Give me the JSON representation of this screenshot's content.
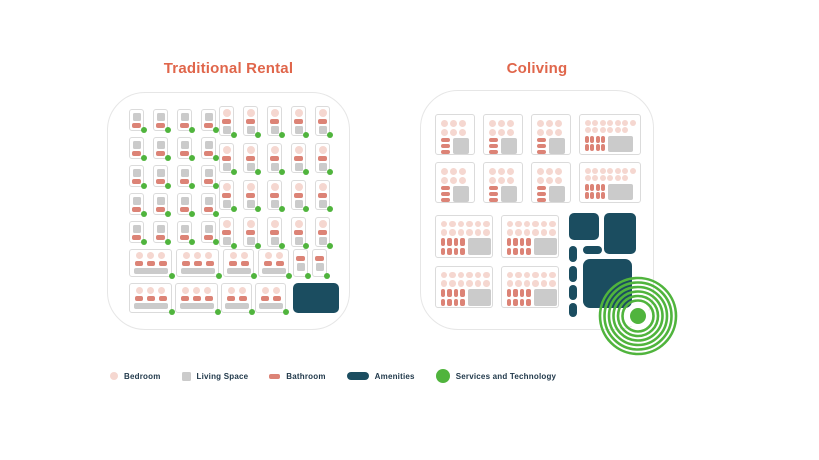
{
  "colors": {
    "title_orange": "#E0664B",
    "bedroom_pink": "#F5D7D0",
    "living_gray": "#CBCBCB",
    "bathroom_salmon": "#DC8376",
    "amenities_teal": "#1B4D60",
    "services_green": "#50B43D",
    "unit_border": "#DBDBDB",
    "container_border": "#E6E6E6",
    "legend_text": "#21394B",
    "background": "#FFFFFF"
  },
  "left_panel": {
    "title": "Traditional Rental",
    "building": {
      "studio_grid_a": {
        "cols": 4,
        "rows": 5,
        "unit": "studio-small"
      },
      "studio_grid_b": {
        "cols": 5,
        "rows": 4,
        "unit": "studio-tall"
      },
      "row_6_units": [
        "large",
        "large",
        "medium",
        "medium",
        "narrow",
        "narrow"
      ],
      "row_7_units": [
        "large",
        "large",
        "medium",
        "medium",
        "amenity"
      ],
      "service_dots_on_units": true
    }
  },
  "right_panel": {
    "title": "Coliving",
    "building": {
      "rows": [
        [
          "suite",
          "suite",
          "suite",
          "suite_wide"
        ],
        [
          "suite",
          "suite",
          "suite",
          "suite_wide"
        ],
        [
          "suite_wide_b",
          "suite_wide_b"
        ],
        [
          "suite_wide_b",
          "suite_wide_b"
        ]
      ],
      "amenities_cluster": {
        "blocks": [
          {
            "x": 148,
            "y": 122,
            "w": 30,
            "h": 27,
            "r": 5
          },
          {
            "x": 183,
            "y": 122,
            "w": 32,
            "h": 41,
            "r": 5
          },
          {
            "x": 148,
            "y": 155,
            "w": 8,
            "h": 16,
            "r": 4
          },
          {
            "x": 162,
            "y": 155,
            "w": 19,
            "h": 8,
            "r": 4
          },
          {
            "x": 162,
            "y": 168,
            "w": 49,
            "h": 49,
            "r": 7
          },
          {
            "x": 148,
            "y": 175,
            "w": 8,
            "h": 16,
            "r": 4
          },
          {
            "x": 148,
            "y": 194,
            "w": 8,
            "h": 15,
            "r": 4
          },
          {
            "x": 148,
            "y": 212,
            "w": 8,
            "h": 14,
            "r": 4
          }
        ]
      },
      "services_target": {
        "rings": 6,
        "center_dot": true
      }
    }
  },
  "legend": {
    "items": [
      {
        "icon": "bedroom-dot-icon",
        "label": "Bedroom"
      },
      {
        "icon": "living-space-square-icon",
        "label": "Living Space"
      },
      {
        "icon": "bathroom-bar-icon",
        "label": "Bathroom"
      },
      {
        "icon": "amenities-pill-icon",
        "label": "Amenities"
      },
      {
        "icon": "services-circle-icon",
        "label": "Services and Technology"
      }
    ]
  }
}
